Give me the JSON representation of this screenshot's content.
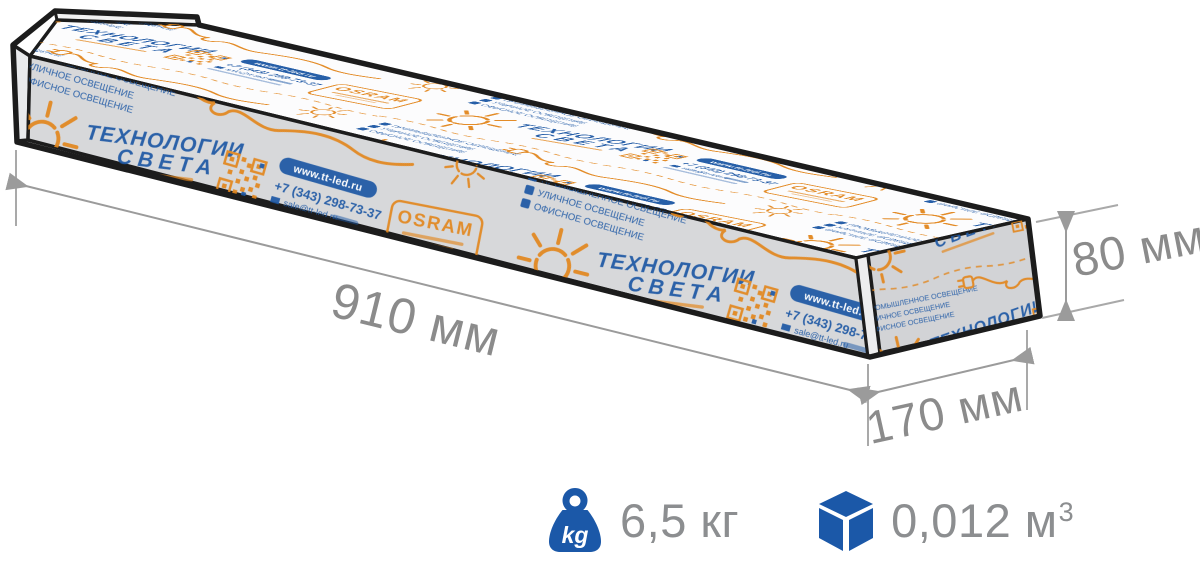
{
  "dimensions": {
    "length": "910 мм",
    "height": "80 мм",
    "depth": "170 мм"
  },
  "specs": {
    "weight_icon_label": "kg",
    "weight_value": "6,5 кг",
    "volume_value": "0,012 м",
    "volume_exponent": "3"
  },
  "brand": {
    "headline_line1": "ТЕХНОЛОГИИ",
    "headline_line2": "СВЕТА",
    "osram_logo": "OSRAM",
    "website": "www.tt-led.ru",
    "phone": "+7 (343) 298-73-37",
    "email": "sale@tt-led.ru",
    "services": [
      "ПРОМЫШЛЕННОЕ ОСВЕЩЕНИЕ",
      "УЛИЧНОЕ ОСВЕЩЕНИЕ",
      "ОФИСНОЕ ОСВЕЩЕНИЕ"
    ]
  },
  "colors": {
    "accent_orange": "#e2861d",
    "accent_blue": "#1c57a4",
    "spec_icon_blue": "#1b58a8",
    "box_front_gray": "#d7d8da",
    "outline": "#1c1c1c",
    "dimension_gray": "#8b8b8b"
  }
}
